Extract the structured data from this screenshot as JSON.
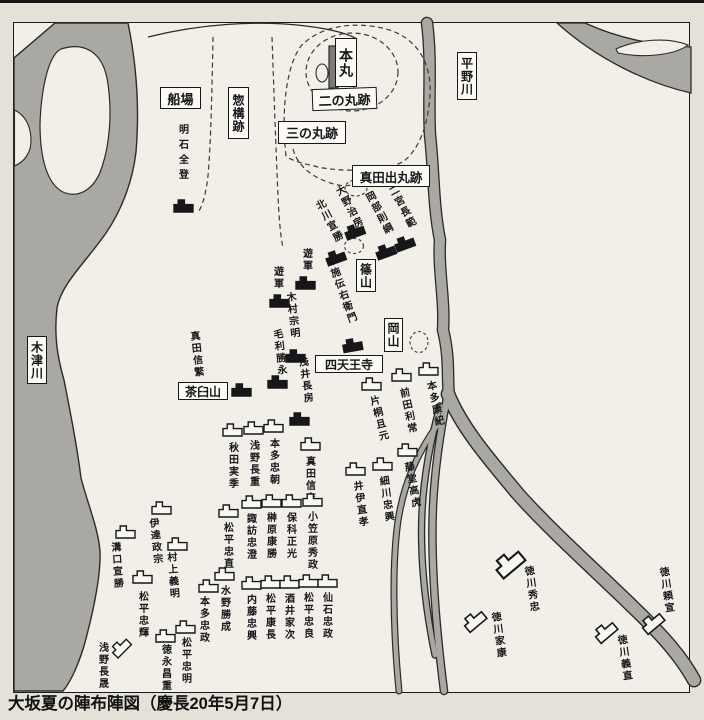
{
  "caption": "大坂夏の陣布陣図（慶長20年5月7日）",
  "colors": {
    "paper": "#e3e1d8",
    "map_bg": "#f1efe7",
    "river": "#a9a8a2",
    "outline": "#2b2b28",
    "ink": "#17171a",
    "box_bg": "#fbfaf5",
    "west_flag": "#17171a",
    "east_flag": "#f8f8f3"
  },
  "places": [
    {
      "id": "senba",
      "label": "船場",
      "o": "h",
      "x": 160,
      "y": 87,
      "w": 41,
      "h": 22,
      "fs": 13
    },
    {
      "id": "sogamae-ato",
      "label": "惣構跡",
      "o": "v",
      "x": 228,
      "y": 87,
      "w": 21,
      "h": 52,
      "fs": 12
    },
    {
      "id": "honmaru",
      "label": "本丸",
      "o": "v",
      "x": 335,
      "y": 38,
      "w": 22,
      "h": 49,
      "fs": 14
    },
    {
      "id": "ninomaru-ato",
      "label": "二の丸跡",
      "o": "h",
      "x": 312,
      "y": 88,
      "w": 65,
      "h": 22,
      "fs": 13,
      "rot": -2
    },
    {
      "id": "sannomaru-ato",
      "label": "三の丸跡",
      "o": "h",
      "x": 278,
      "y": 121,
      "w": 68,
      "h": 23,
      "fs": 13
    },
    {
      "id": "sanada-demaru-ato",
      "label": "真田出丸跡",
      "o": "h",
      "x": 352,
      "y": 165,
      "w": 78,
      "h": 22,
      "fs": 12.5
    },
    {
      "id": "hirano-river",
      "label": "平野川",
      "o": "v",
      "x": 457,
      "y": 52,
      "w": 20,
      "h": 48,
      "fs": 12
    },
    {
      "id": "kizu-river",
      "label": "木津川",
      "o": "v",
      "x": 27,
      "y": 336,
      "w": 20,
      "h": 48,
      "fs": 12
    },
    {
      "id": "sasayama",
      "label": "篠山",
      "o": "v",
      "x": 356,
      "y": 259,
      "w": 20,
      "h": 33,
      "fs": 12
    },
    {
      "id": "okayama",
      "label": "岡山",
      "o": "v",
      "x": 384,
      "y": 318,
      "w": 19,
      "h": 34,
      "fs": 12
    },
    {
      "id": "shitennoji",
      "label": "四天王寺",
      "o": "h",
      "x": 315,
      "y": 355,
      "w": 68,
      "h": 18,
      "fs": 12
    },
    {
      "id": "chausuyama",
      "label": "茶臼山",
      "o": "h",
      "x": 178,
      "y": 382,
      "w": 50,
      "h": 18,
      "fs": 12
    }
  ],
  "units": {
    "west": [
      {
        "n": "明石全登",
        "t": [
          176,
          124
        ],
        "f": [
          183,
          206
        ],
        "sp": 5
      },
      {
        "n": "大野治房",
        "t": [
          331,
          187
        ],
        "tr": -28,
        "f": [
          354,
          231
        ],
        "fr": -20
      },
      {
        "n": "北川宣勝",
        "t": [
          311,
          201
        ],
        "tr": -28,
        "f": [
          335,
          257
        ],
        "fr": -20
      },
      {
        "n": "岡部則綱",
        "t": [
          361,
          193
        ],
        "tr": -28,
        "f": [
          385,
          251
        ],
        "fr": -20
      },
      {
        "n": "二宮長範",
        "t": [
          384,
          187
        ],
        "tr": -28,
        "f": [
          404,
          243
        ],
        "fr": -20
      },
      {
        "n": "布施伝右衛門",
        "t": [
          322,
          257
        ],
        "tr": -20,
        "f": [
          352,
          345
        ],
        "fr": -10
      },
      {
        "n": "遊軍",
        "t": [
          300,
          248
        ],
        "f": [
          305,
          283
        ]
      },
      {
        "n": "遊軍",
        "t": [
          271,
          266
        ],
        "f": [
          279,
          301
        ]
      },
      {
        "n": "木村宗明",
        "t": [
          283,
          292
        ],
        "tr": -6,
        "f": [
          295,
          356
        ]
      },
      {
        "n": "毛利勝永",
        "t": [
          270,
          329
        ],
        "tr": -6,
        "f": [
          277,
          382
        ]
      },
      {
        "n": "浅井長房",
        "t": [
          295,
          357
        ],
        "tr": -8,
        "f": [
          299,
          419
        ]
      },
      {
        "n": "真田信繁",
        "t": [
          187,
          331
        ],
        "tr": -6,
        "f": [
          241,
          390
        ]
      }
    ],
    "east": [
      {
        "n": "片桐且元",
        "t": [
          366,
          396
        ],
        "tr": -14,
        "f": [
          371,
          384
        ]
      },
      {
        "n": "前田利常",
        "t": [
          396,
          388
        ],
        "tr": -12,
        "f": [
          401,
          375
        ]
      },
      {
        "n": "本多康紀",
        "t": [
          423,
          381
        ],
        "tr": -12,
        "f": [
          428,
          369
        ]
      },
      {
        "n": "藤堂高虎",
        "t": [
          401,
          462
        ],
        "tr": -10,
        "f": [
          407,
          450
        ]
      },
      {
        "n": "細川忠興",
        "t": [
          376,
          476
        ],
        "tr": -8,
        "f": [
          382,
          464
        ]
      },
      {
        "n": "井伊直孝",
        "t": [
          350,
          481
        ],
        "tr": -8,
        "f": [
          355,
          469
        ]
      },
      {
        "n": "秋田実季",
        "t": [
          226,
          442
        ],
        "f": [
          232,
          430
        ]
      },
      {
        "n": "浅野長重",
        "t": [
          247,
          440
        ],
        "f": [
          253,
          428
        ]
      },
      {
        "n": "本多忠朝",
        "t": [
          267,
          438
        ],
        "f": [
          273,
          426
        ]
      },
      {
        "n": "真田信吉",
        "t": [
          303,
          456
        ],
        "f": [
          310,
          444
        ]
      },
      {
        "n": "松平忠直",
        "t": [
          221,
          522
        ],
        "f": [
          228,
          511
        ]
      },
      {
        "n": "諏訪忠澄",
        "t": [
          244,
          513
        ],
        "f": [
          251,
          502
        ]
      },
      {
        "n": "榊原康勝",
        "t": [
          264,
          512
        ],
        "f": [
          271,
          501
        ]
      },
      {
        "n": "保科正光",
        "t": [
          284,
          512
        ],
        "f": [
          291,
          501
        ]
      },
      {
        "n": "小笠原秀政",
        "t": [
          305,
          511
        ],
        "f": [
          312,
          500
        ]
      },
      {
        "n": "内藤忠興",
        "t": [
          244,
          594
        ],
        "f": [
          251,
          583
        ]
      },
      {
        "n": "松平康長",
        "t": [
          263,
          593
        ],
        "f": [
          270,
          582
        ]
      },
      {
        "n": "酒井家次",
        "t": [
          282,
          593
        ],
        "f": [
          289,
          582
        ]
      },
      {
        "n": "松平忠良",
        "t": [
          301,
          592
        ],
        "f": [
          308,
          581
        ]
      },
      {
        "n": "仙石忠政",
        "t": [
          320,
          592
        ],
        "f": [
          327,
          581
        ]
      },
      {
        "n": "伊達政宗",
        "t": [
          146,
          518
        ],
        "tr": -6,
        "f": [
          161,
          508
        ]
      },
      {
        "n": "溝口宣勝",
        "t": [
          108,
          542
        ],
        "tr": -4,
        "f": [
          125,
          532
        ]
      },
      {
        "n": "村上義明",
        "t": [
          164,
          552
        ],
        "tr": -4,
        "f": [
          177,
          544
        ]
      },
      {
        "n": "松平忠輝",
        "t": [
          136,
          591
        ],
        "f": [
          142,
          577
        ]
      },
      {
        "n": "水野勝成",
        "t": [
          218,
          585
        ],
        "f": [
          224,
          574
        ]
      },
      {
        "n": "本多忠政",
        "t": [
          197,
          596
        ],
        "f": [
          208,
          586
        ]
      },
      {
        "n": "松平忠明",
        "t": [
          179,
          637
        ],
        "f": [
          185,
          627
        ]
      },
      {
        "n": "徳永昌重",
        "t": [
          159,
          644
        ],
        "f": [
          165,
          636
        ]
      },
      {
        "n": "浅野長晟",
        "t": [
          96,
          642
        ],
        "f": [
          120,
          647
        ],
        "fr": -45
      },
      {
        "n": "徳川秀忠",
        "t": [
          521,
          566
        ],
        "tr": -8,
        "f": [
          509,
          562
        ],
        "fr": -40,
        "fs": 1.5
      },
      {
        "n": "徳川家康",
        "t": [
          488,
          612
        ],
        "tr": -8,
        "f": [
          474,
          620
        ],
        "fr": -40,
        "fs": 1.15
      },
      {
        "n": "徳川義直",
        "t": [
          614,
          635
        ],
        "tr": -8,
        "f": [
          605,
          631
        ],
        "fr": -40,
        "fs": 1.15
      },
      {
        "n": "徳川頼宣",
        "t": [
          656,
          567
        ],
        "tr": -8,
        "f": [
          652,
          622
        ],
        "fr": -40,
        "fs": 1.15
      }
    ]
  }
}
